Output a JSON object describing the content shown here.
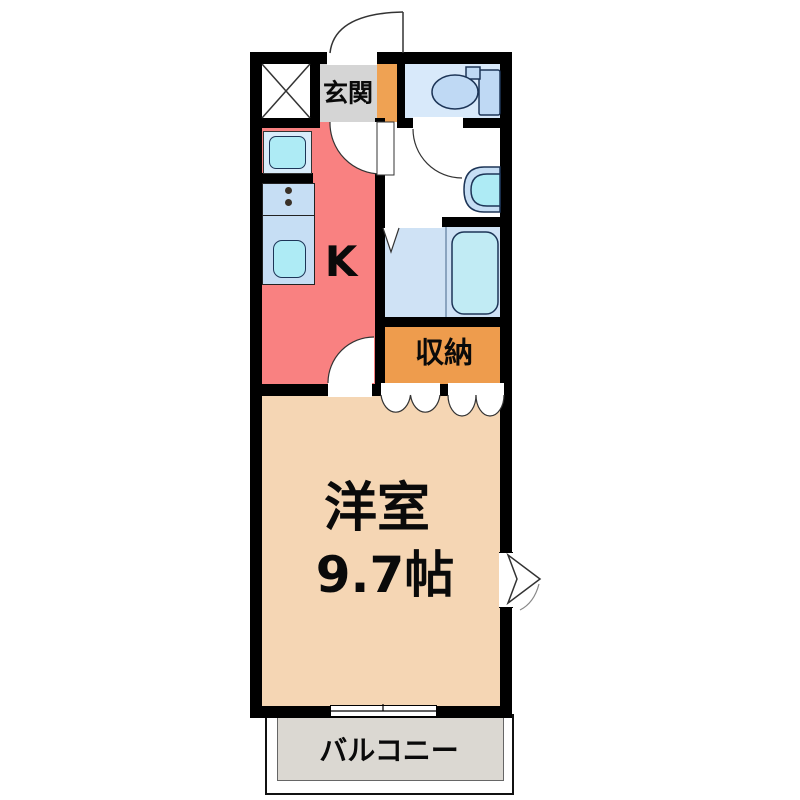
{
  "floorplan": {
    "title": "1K apartment floor plan",
    "rooms": {
      "genkan": {
        "label": "玄関"
      },
      "kitchen": {
        "label": "K"
      },
      "storage": {
        "label": "収納"
      },
      "western_room": {
        "label": "洋室",
        "size": "9.7帖"
      },
      "balcony": {
        "label": "バルコニー"
      }
    },
    "fixtures": [
      "pipe-space-x",
      "toilet",
      "washbasin",
      "bathtub",
      "bath-folding-door",
      "washing-machine-pan",
      "stove-burners",
      "kitchen-sink",
      "entry-door-swing",
      "kitchen-door-swing",
      "toilet-door-swing",
      "closet-double-doors",
      "sliding-window",
      "side-window-arrow"
    ],
    "colors": {
      "wall": "#000000",
      "kitchen_floor": "#F98181",
      "genkan_floor": "#D5D5D5",
      "entry_step": "#EFA253",
      "storage": "#EE9C4D",
      "western_room": "#F5D6B4",
      "balcony": "#DBD8D2",
      "toilet_floor": "#D8E9FA",
      "bath_floor": "#CFE2F5",
      "fixture_light_blue": "#C6DEF4",
      "fixture_cyan": "#AEEBF5",
      "fixture_outline": "#1d3557"
    }
  }
}
